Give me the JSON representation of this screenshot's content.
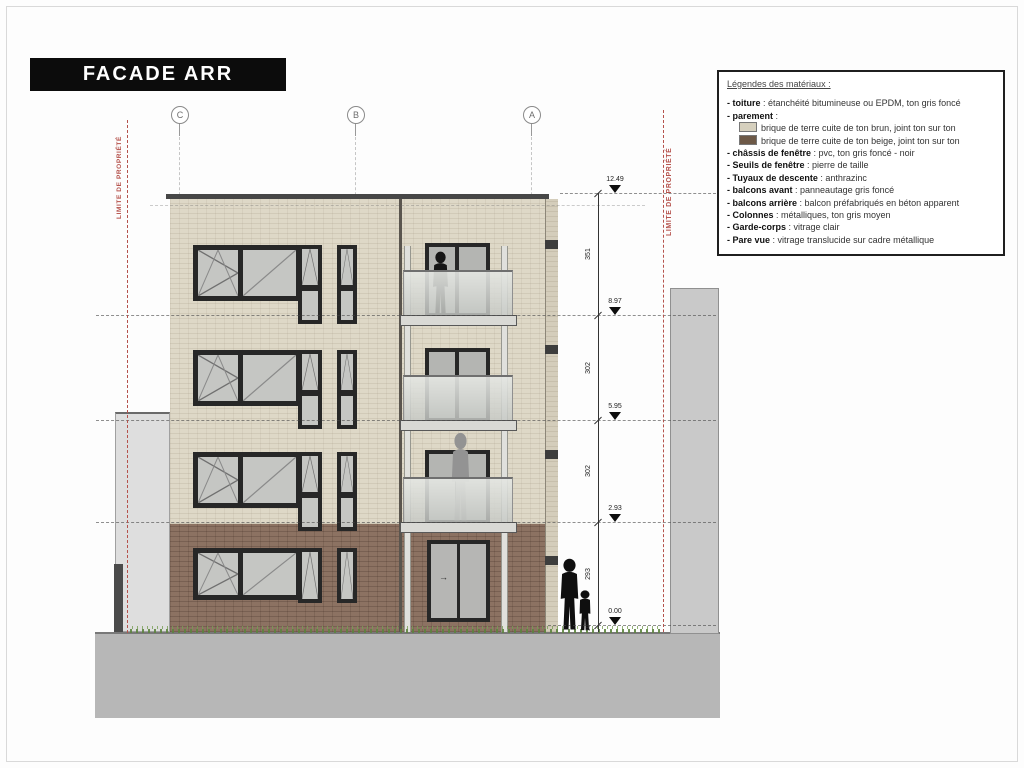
{
  "title": "FACADE ARR",
  "legend": {
    "title": "Légendes des matériaux :",
    "items": [
      {
        "label": "- toiture",
        "text": " : étanchéité bitumineuse ou EPDM, ton gris foncé"
      },
      {
        "label": "- parement",
        "text": " :"
      },
      {
        "label": "",
        "text": "brique de terre cuite de ton brun, joint ton sur ton",
        "swatch": "beige"
      },
      {
        "label": "",
        "text": "brique de terre cuite de ton beige, joint ton sur ton",
        "swatch": "brown"
      },
      {
        "label": "- châssis de fenêtre",
        "text": " : pvc, ton gris foncé - noir"
      },
      {
        "label": "- Seuils de fenêtre",
        "text": " : pierre de taille"
      },
      {
        "label": "- Tuyaux de descente",
        "text": " : anthrazinc"
      },
      {
        "label": "- balcons avant",
        "text": " : panneautage gris foncé"
      },
      {
        "label": "- balcons arrière",
        "text": " : balcon préfabriqués en béton apparent"
      },
      {
        "label": "- Colonnes",
        "text": " : métalliques, ton gris moyen"
      },
      {
        "label": "- Garde-corps",
        "text": " : vitrage clair"
      },
      {
        "label": "- Pare vue",
        "text": " : vitrage translucide sur cadre métallique"
      }
    ]
  },
  "grid_axes": {
    "left": "C",
    "middle": "B",
    "right": "A"
  },
  "property_limit": {
    "label": "LIMITE DE PROPRIÉTÉ"
  },
  "levels": [
    {
      "value": "12.49"
    },
    {
      "value": "8.97"
    },
    {
      "value": "5.95"
    },
    {
      "value": "2.93"
    },
    {
      "value": "0.00"
    }
  ],
  "dimensions": [
    "351",
    "302",
    "302",
    "293"
  ],
  "ground_offset": "10",
  "door_arrow": "→",
  "colors": {
    "brick_beige": "#ded8c7",
    "brick_brown": "#8c7262",
    "window_frame": "#272727",
    "glass": "#c5c6c3",
    "balcony_glass": "#d8dad6",
    "column_metal": "#e0e0dc",
    "property_limit_red": "#b5524c",
    "neighbor_wall": "#c9c9c9",
    "ground": "#b7b7b7",
    "grass": "#6f9a50",
    "title_bg": "#0c0c0c",
    "legend_swatch_beige": "#d6d0be",
    "legend_swatch_brown": "#6d5947"
  }
}
